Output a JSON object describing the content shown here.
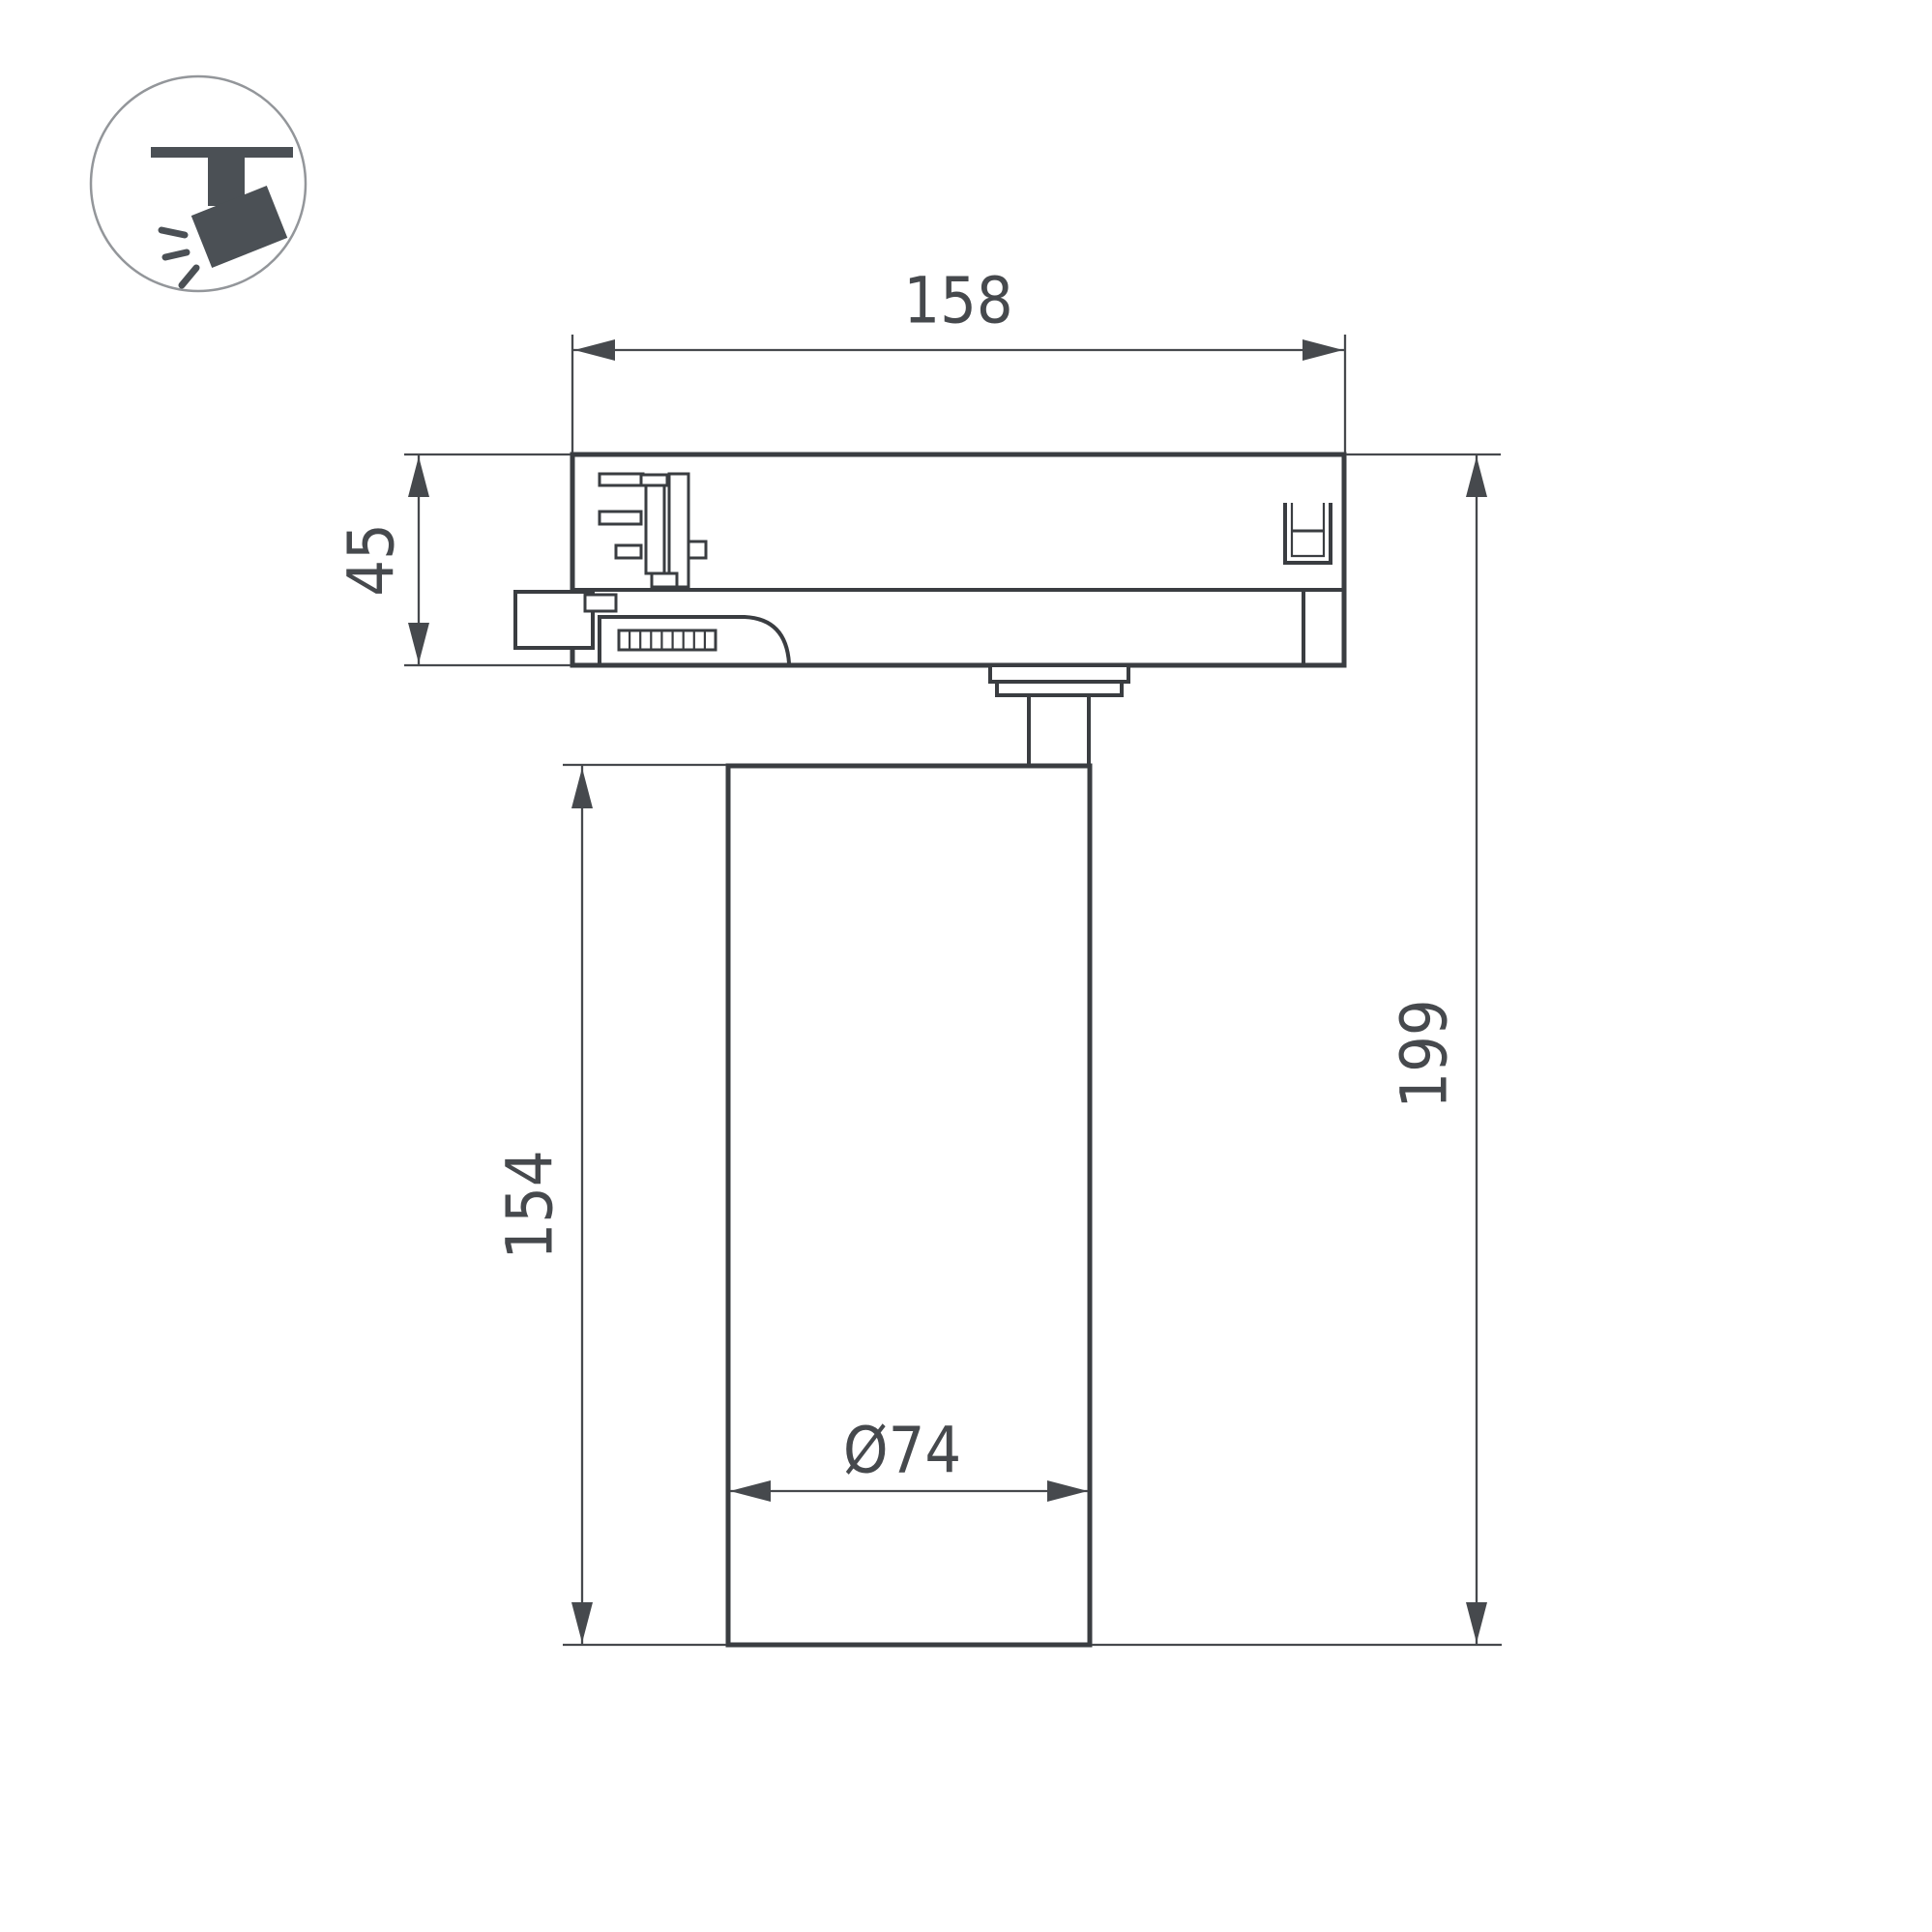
{
  "icon": {
    "name": "track-spotlight-icon"
  },
  "dimensions": {
    "track_adapter_width": "158",
    "adapter_height": "45",
    "body_height": "154",
    "total_height": "199",
    "body_diameter": "Ø74"
  },
  "colors": {
    "outline": "#3a3d41",
    "dimension": "#46494d",
    "icon": "#4b5055",
    "iconCircle": "#93969a",
    "background": "#ffffff"
  }
}
